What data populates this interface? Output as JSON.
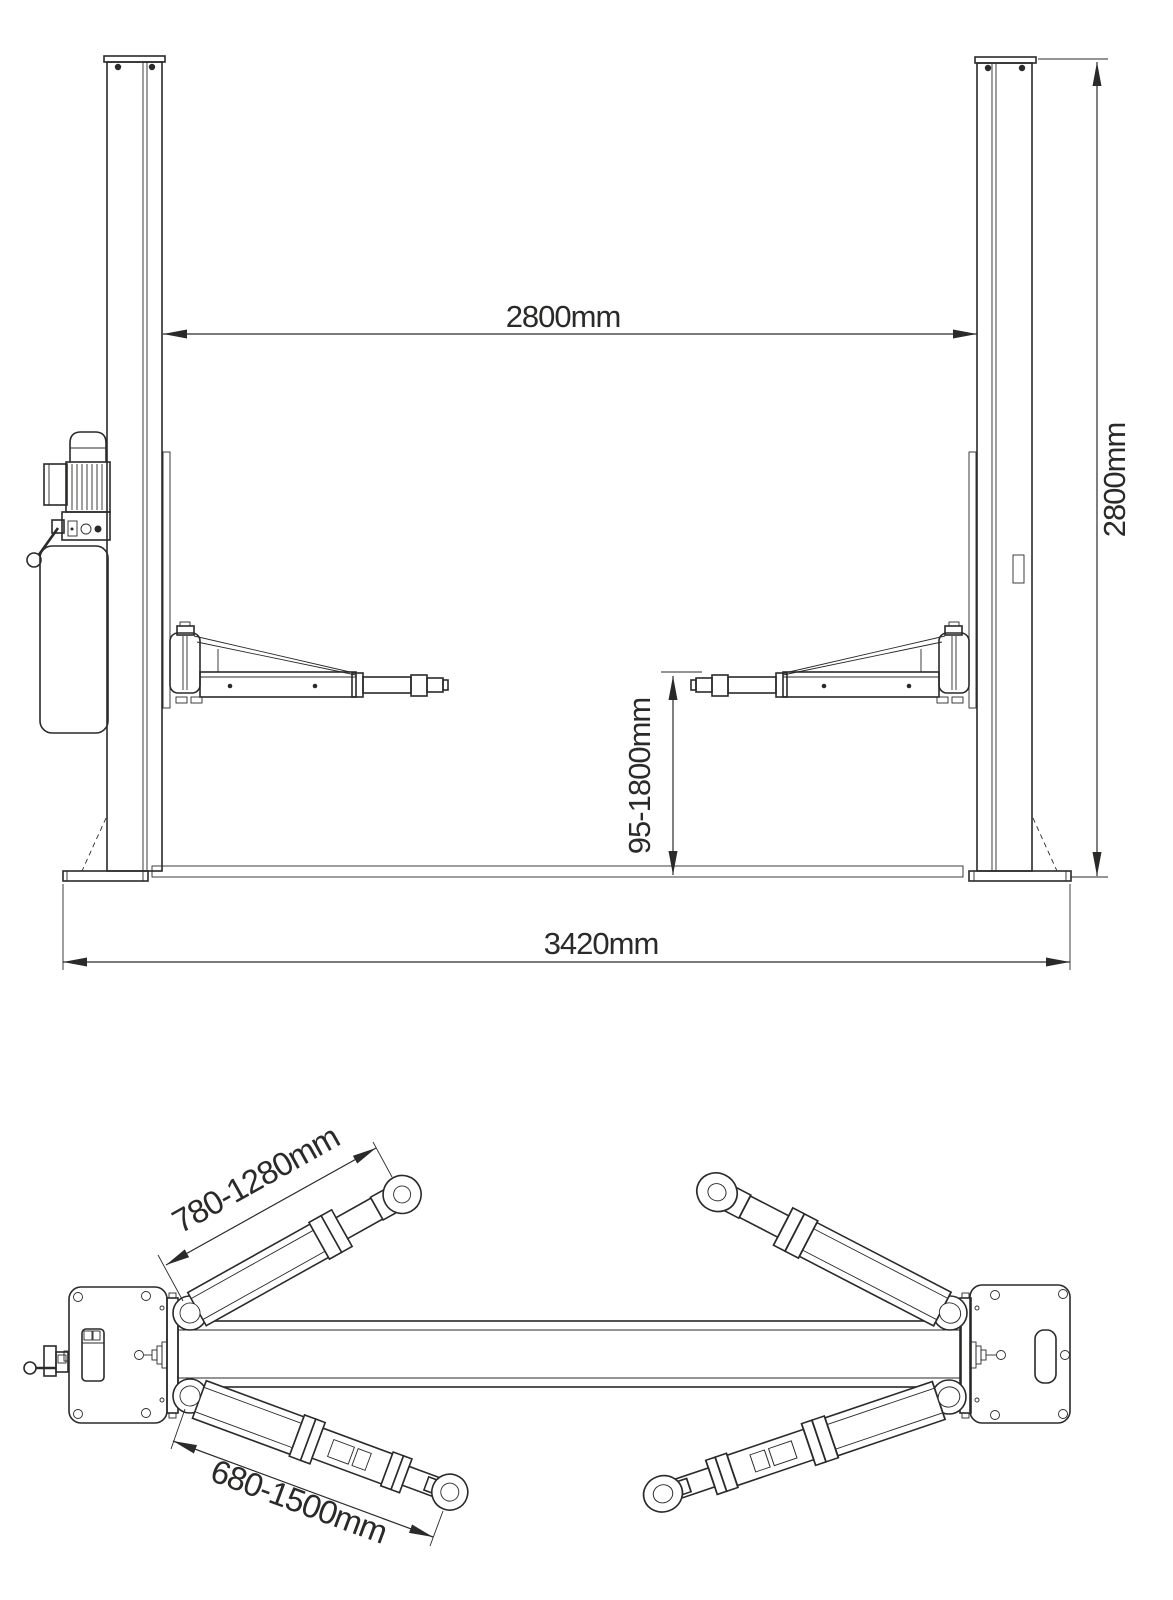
{
  "drawing": {
    "background": "#ffffff",
    "line_color": "#2b2a29",
    "front_view": {
      "dim_column_spacing": "2800mm",
      "dim_overall_height": "2800mm",
      "dim_lifting_height_range": "95-1800mm",
      "dim_overall_base_width": "3420mm"
    },
    "top_view": {
      "dim_short_arm_reach": "780-1280mm",
      "dim_long_arm_reach": "680-1500mm"
    }
  }
}
